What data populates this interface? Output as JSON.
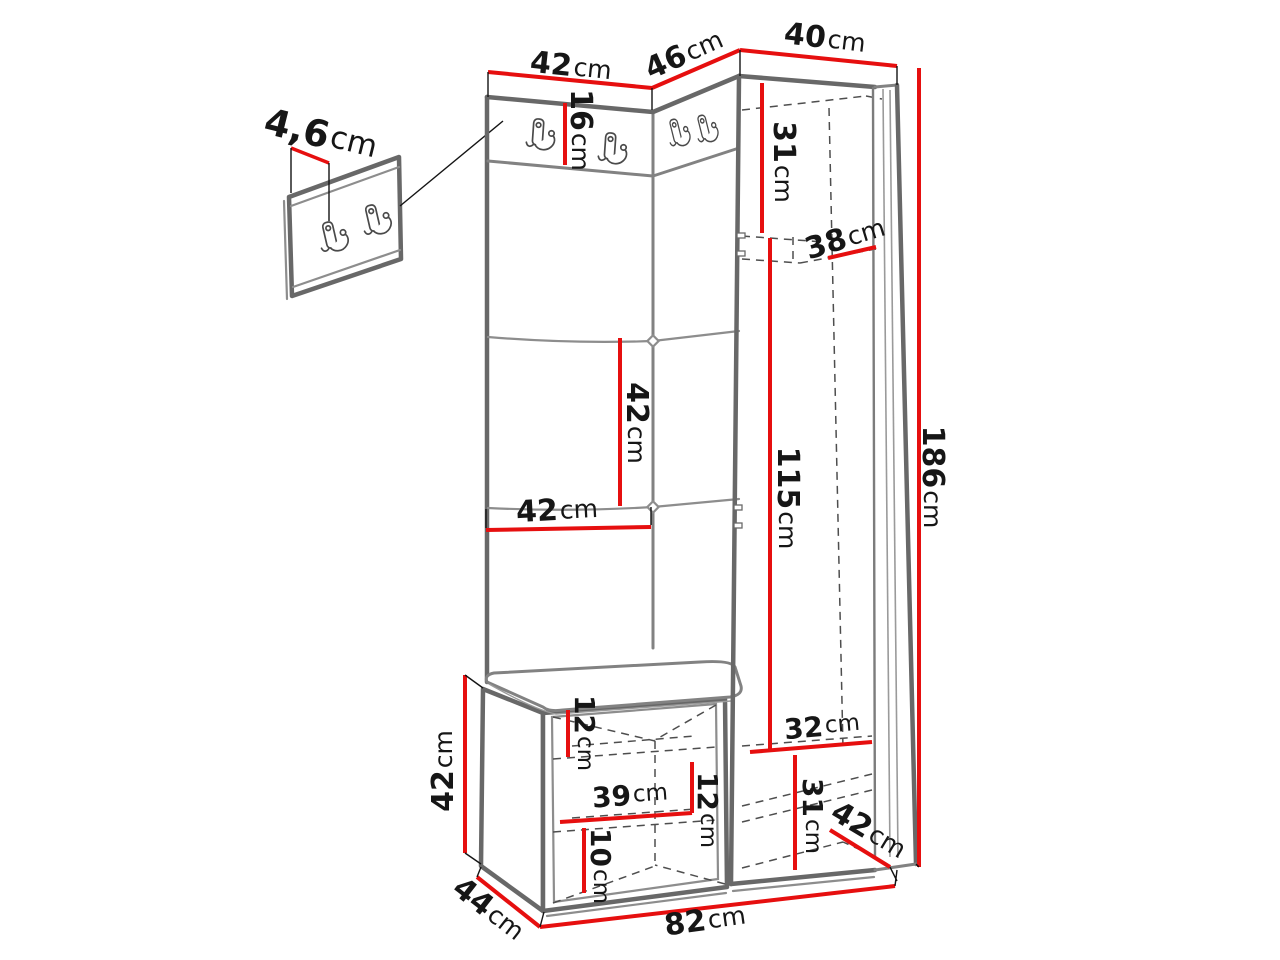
{
  "diagram": {
    "type": "furniture-dimension-drawing",
    "subject": "hallway set: wall hook panel, upholstered panels with coat hooks, wardrobe and shoe bench",
    "unit": "cm",
    "colors": {
      "dimension_line": "#e60f0f",
      "outline": "#686868",
      "hidden_line": "#4e4e4e",
      "text": "#161616",
      "background": "#ffffff"
    },
    "icons": {
      "coat_hook": "double-prong-coat-hook"
    },
    "dimensions": {
      "panel_thickness": {
        "value": "4,6",
        "unit": "cm"
      },
      "width_left_section": {
        "value": "42",
        "unit": "cm"
      },
      "width_corner_section": {
        "value": "46",
        "unit": "cm"
      },
      "width_wardrobe": {
        "value": "40",
        "unit": "cm"
      },
      "hook_panel_height": {
        "value": "16",
        "unit": "cm"
      },
      "wardrobe_top_height": {
        "value": "31",
        "unit": "cm"
      },
      "wardrobe_inner_width": {
        "value": "38",
        "unit": "cm"
      },
      "upholstered_panel_height": {
        "value": "42",
        "unit": "cm"
      },
      "upholstered_panel_width": {
        "value": "42",
        "unit": "cm"
      },
      "hanging_space_height": {
        "value": "115",
        "unit": "cm"
      },
      "total_height": {
        "value": "186",
        "unit": "cm"
      },
      "bench_opening_top": {
        "value": "12",
        "unit": "cm"
      },
      "bench_inner_width": {
        "value": "39",
        "unit": "cm"
      },
      "bench_shelf_spacing": {
        "value": "12",
        "unit": "cm"
      },
      "bench_opening_bottom": {
        "value": "10",
        "unit": "cm"
      },
      "lower_compartment_width": {
        "value": "32",
        "unit": "cm"
      },
      "lower_compartment_height": {
        "value": "31",
        "unit": "cm"
      },
      "wardrobe_depth": {
        "value": "42",
        "unit": "cm"
      },
      "bench_height": {
        "value": "42",
        "unit": "cm"
      },
      "bench_depth": {
        "value": "44",
        "unit": "cm"
      },
      "total_width": {
        "value": "82",
        "unit": "cm"
      }
    }
  }
}
